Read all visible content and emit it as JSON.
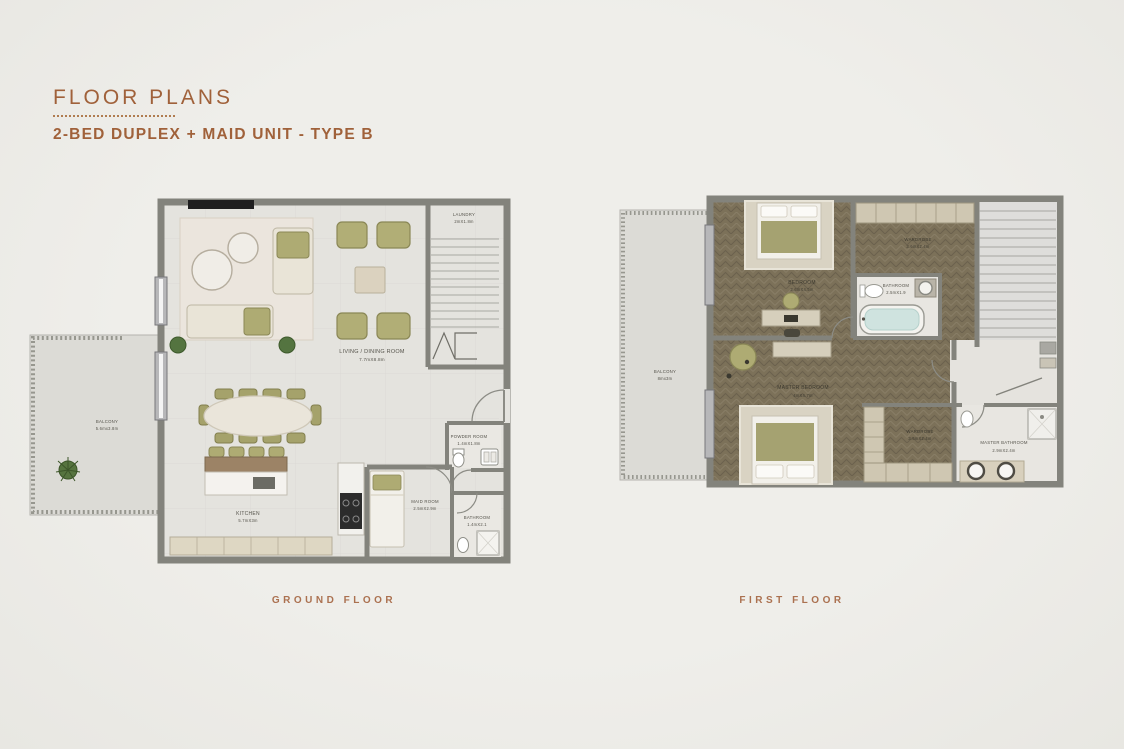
{
  "header": {
    "title": "FLOOR PLANS",
    "subtitle": "2-BED DUPLEX + MAID UNIT - TYPE B"
  },
  "ground_floor": {
    "caption": "GROUND FLOOR",
    "rooms": {
      "laundry": {
        "name": "LAUNDRY",
        "dims": "2mX1.8m"
      },
      "living_dining": {
        "name": "LIVING / DINING ROOM",
        "dims": "7.7mX8.8m"
      },
      "balcony": {
        "name": "BALCONY",
        "dims": "5.6mx3.8m"
      },
      "kitchen": {
        "name": "KITCHEN",
        "dims": "5.7mX3m"
      },
      "powder_room": {
        "name": "POWDER ROOM",
        "dims": "1.4mX1.8m"
      },
      "maid_room": {
        "name": "MAID ROOM",
        "dims": "2.5mX2.9m"
      },
      "bathroom": {
        "name": "BATHROOM",
        "dims": "1.4mX2.1"
      }
    }
  },
  "first_floor": {
    "caption": "FIRST FLOOR",
    "rooms": {
      "bedroom": {
        "name": "BEDROOM",
        "dims": "3.6mX4.5m"
      },
      "wardrobe_top": {
        "name": "WARDROBE",
        "dims": "3.6mX2.4m"
      },
      "bathroom": {
        "name": "BATHROOM",
        "dims": "2.5mX1.9"
      },
      "master_bedroom": {
        "name": "MASTER BEDROOM",
        "dims": "4mX4.7m"
      },
      "balcony": {
        "name": "BALCONY",
        "dims": "8mx3m"
      },
      "wardrobe_bottom": {
        "name": "WARDROBE",
        "dims": "3.6mX2.4m"
      },
      "master_bathroom": {
        "name": "MASTER BATHROOM",
        "dims": "2.9mX2.4m"
      }
    }
  },
  "colors": {
    "accent": "#a0613a",
    "background": "#efeeea",
    "wall": "#83837c",
    "floor_light": "#e4e3de",
    "wood_floor": "#7c7159",
    "olive_furniture": "#aeab73",
    "cream_furniture": "#e9e4d7"
  }
}
